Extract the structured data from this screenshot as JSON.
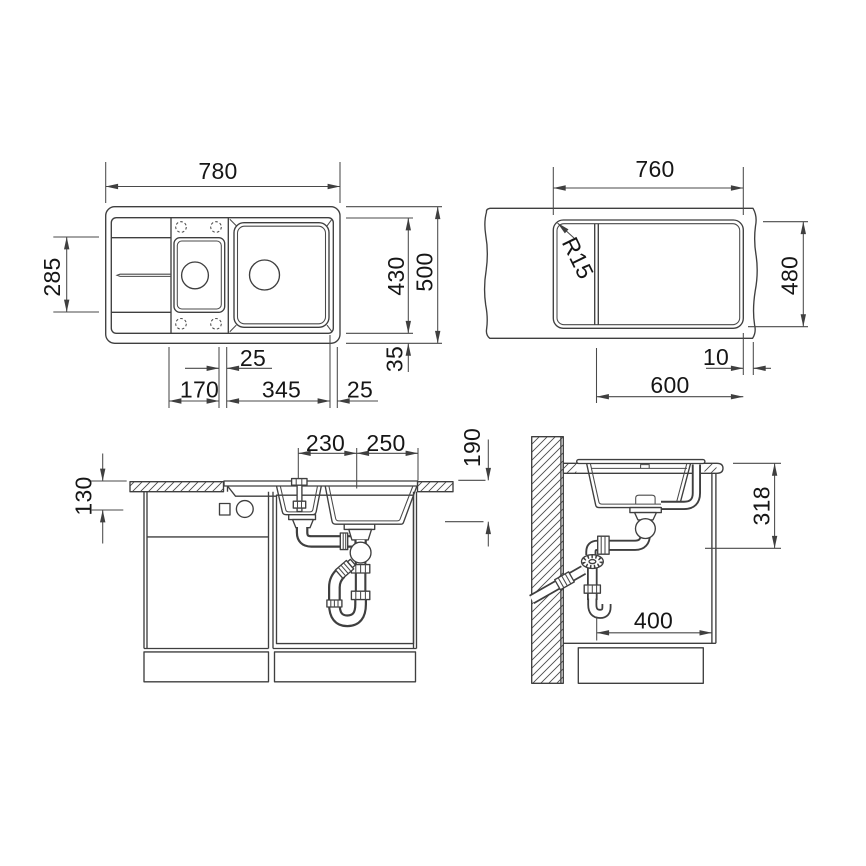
{
  "drawing_title": "sink-installation-dimension-drawing",
  "dims": {
    "plan": {
      "overall_width": "780",
      "drainboard_depth": "285",
      "basin_area_depth": "430",
      "overall_depth": "500",
      "edge_margin": "35",
      "bowl_gap": "25",
      "small_bowl_width": "170",
      "large_bowl_width": "345",
      "right_margin": "25"
    },
    "cutout": {
      "width": "760",
      "corner_radius": "R15",
      "depth": "480",
      "edge_offset": "10",
      "length": "600"
    },
    "front": {
      "tap_to_divider": "230",
      "divider_to_edge": "250",
      "small_bowl_depth": "130",
      "large_bowl_depth": "190"
    },
    "side": {
      "mounting_depth": "318",
      "drain_clearance": "400"
    }
  }
}
